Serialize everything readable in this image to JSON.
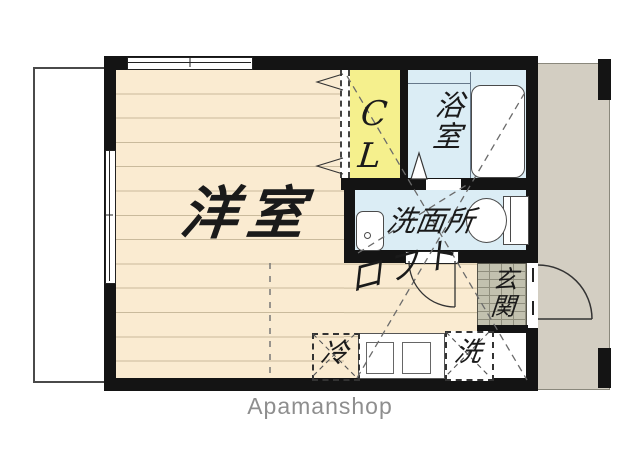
{
  "plan_title": "studio-apartment-floor-plan",
  "rooms": {
    "living": {
      "label": "洋室"
    },
    "closet": {
      "label": "CL"
    },
    "bath": {
      "label": "浴室"
    },
    "washroom": {
      "label": "洗面所"
    },
    "entrance": {
      "label": "玄関"
    },
    "loft": {
      "label": "ロフト"
    }
  },
  "appliances": {
    "refrigerator": {
      "label": "冷"
    },
    "washer": {
      "label": "洗"
    }
  },
  "watermark": "Apamanshop",
  "colors": {
    "floor": "#FAEBD1",
    "floor-line": "#C9BA9C",
    "closet": "#F5F08D",
    "wet": "#DBEDF5",
    "tile": "#C2C1AF",
    "tile-line": "#8F8E7D",
    "corridor": "#D3CEC2",
    "wall": "#141414",
    "watermark": "#8E8E8E"
  }
}
